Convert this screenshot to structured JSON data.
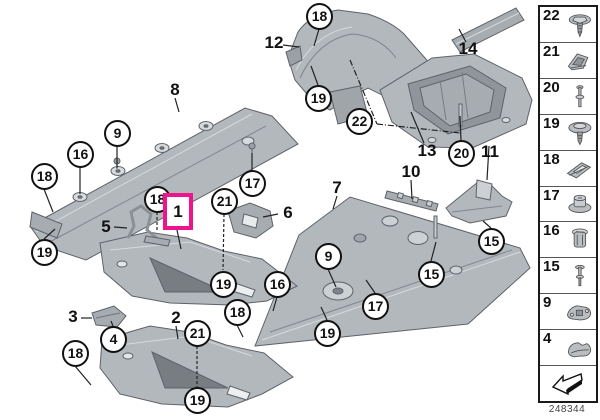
{
  "drawing_number": "248344",
  "highlight": {
    "label": "1",
    "color": "#f0148c"
  },
  "callouts": {
    "circles": [
      {
        "label": "18"
      },
      {
        "label": "19"
      },
      {
        "label": "22"
      },
      {
        "label": "20"
      },
      {
        "label": "9"
      },
      {
        "label": "16"
      },
      {
        "label": "18"
      },
      {
        "label": "17"
      },
      {
        "label": "18"
      },
      {
        "label": "21"
      },
      {
        "label": "19"
      },
      {
        "label": "15"
      },
      {
        "label": "9"
      },
      {
        "label": "16"
      },
      {
        "label": "15"
      },
      {
        "label": "17"
      },
      {
        "label": "19"
      },
      {
        "label": "18"
      },
      {
        "label": "19"
      },
      {
        "label": "4"
      },
      {
        "label": "21"
      },
      {
        "label": "18"
      },
      {
        "label": "19"
      }
    ],
    "labels": [
      {
        "label": "12"
      },
      {
        "label": "14"
      },
      {
        "label": "13"
      },
      {
        "label": "11"
      },
      {
        "label": "8"
      },
      {
        "label": "10"
      },
      {
        "label": "7"
      },
      {
        "label": "6"
      },
      {
        "label": "5"
      },
      {
        "label": "3"
      },
      {
        "label": "2"
      }
    ]
  },
  "sidebar": {
    "items": [
      {
        "label": "22",
        "icon": "flange-screw-rivet-icon"
      },
      {
        "label": "21",
        "icon": "clamp-clip-icon"
      },
      {
        "label": "20",
        "icon": "long-pin-rivet-icon"
      },
      {
        "label": "19",
        "icon": "mushroom-rivet-icon"
      },
      {
        "label": "18",
        "icon": "speed-nut-clip-icon"
      },
      {
        "label": "17",
        "icon": "flanged-nut-icon"
      },
      {
        "label": "16",
        "icon": "expansion-nut-icon"
      },
      {
        "label": "15",
        "icon": "blind-rivet-icon"
      },
      {
        "label": "9",
        "icon": "cover-plate-icon"
      },
      {
        "label": "4",
        "icon": "cap-cover-icon"
      }
    ]
  },
  "colors": {
    "part_fill": "#b3b8bd",
    "part_stroke": "#5d636a",
    "highlight": "#f0148c"
  }
}
